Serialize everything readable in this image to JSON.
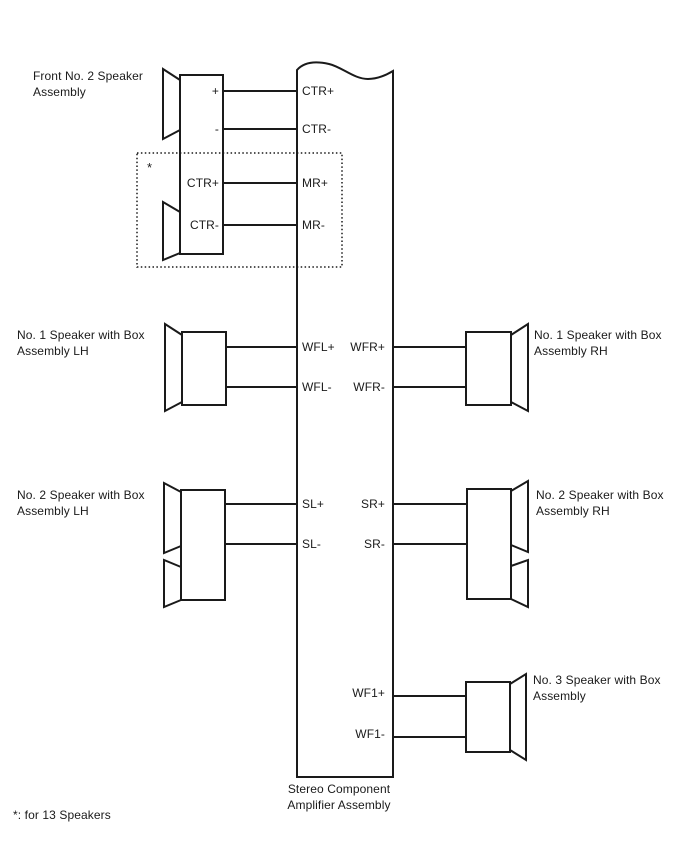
{
  "amplifier": {
    "label": [
      "Stereo Component",
      "Amplifier Assembly"
    ],
    "terminals": {
      "ctr_plus": "CTR+",
      "ctr_minus": "CTR-",
      "mr_plus": "MR+",
      "mr_minus": "MR-",
      "wfl_plus": "WFL+",
      "wfl_minus": "WFL-",
      "wfr_plus": "WFR+",
      "wfr_minus": "WFR-",
      "sl_plus": "SL+",
      "sl_minus": "SL-",
      "sr_plus": "SR+",
      "sr_minus": "SR-",
      "wf1_plus": "WF1+",
      "wf1_minus": "WF1-"
    }
  },
  "speakers": {
    "front_no2": {
      "label": [
        "Front No. 2 Speaker",
        "Assembly"
      ],
      "terminals": {
        "plus": "+",
        "minus": "-",
        "ctr_plus": "CTR+",
        "ctr_minus": "CTR-"
      }
    },
    "no1_lh": {
      "label": [
        "No. 1 Speaker with Box",
        "Assembly LH"
      ]
    },
    "no1_rh": {
      "label": [
        "No. 1 Speaker with Box",
        "Assembly RH"
      ]
    },
    "no2_lh": {
      "label": [
        "No. 2 Speaker with Box",
        "Assembly LH"
      ]
    },
    "no2_rh": {
      "label": [
        "No. 2 Speaker with Box",
        "Assembly RH"
      ]
    },
    "no3": {
      "label": [
        "No. 3 Speaker with Box",
        "Assembly"
      ]
    }
  },
  "annotations": {
    "asterisk": "*",
    "footnote": "*: for 13 Speakers"
  },
  "colors": {
    "line": "#1a1a1a",
    "background": "#ffffff"
  }
}
